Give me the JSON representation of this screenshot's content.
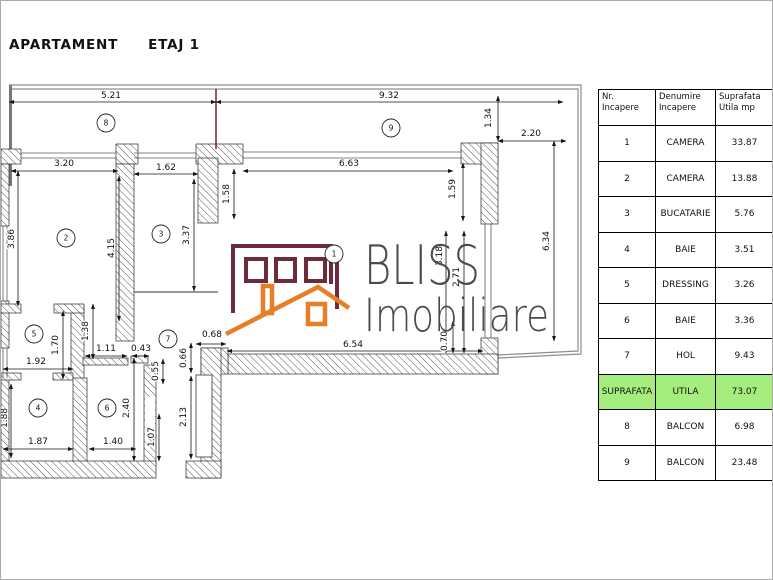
{
  "title": {
    "label": "APARTAMENT",
    "floor_label": "ETAJ 1"
  },
  "logo": {
    "brand": "BLISS",
    "brand_sub": "Imobiliare",
    "building_color": "#6e2a3a",
    "roof_color": "#e67f28",
    "text_color": "#4a4a4a"
  },
  "floor_plan": {
    "room_markers": [
      {
        "number": "8",
        "x": 105,
        "y": 122
      },
      {
        "number": "9",
        "x": 390,
        "y": 127
      },
      {
        "number": "2",
        "x": 65,
        "y": 237
      },
      {
        "number": "3",
        "x": 160,
        "y": 233
      },
      {
        "number": "1",
        "x": 333,
        "y": 253
      },
      {
        "number": "5",
        "x": 33,
        "y": 333
      },
      {
        "number": "7",
        "x": 167,
        "y": 338
      },
      {
        "number": "4",
        "x": 37,
        "y": 407
      },
      {
        "number": "6",
        "x": 106,
        "y": 407
      }
    ],
    "dimensions": [
      {
        "label": "5.21",
        "x": 110,
        "y": 97
      },
      {
        "label": "9.32",
        "x": 388,
        "y": 97
      },
      {
        "label": "1.34",
        "x": 490,
        "y": 117,
        "rot": true
      },
      {
        "label": "2.20",
        "x": 530,
        "y": 135
      },
      {
        "label": "3.20",
        "x": 63,
        "y": 165
      },
      {
        "label": "1.62",
        "x": 165,
        "y": 169
      },
      {
        "label": "6.63",
        "x": 348,
        "y": 165
      },
      {
        "label": "1.58",
        "x": 228,
        "y": 193,
        "rot": true
      },
      {
        "label": "1.59",
        "x": 454,
        "y": 188,
        "rot": true
      },
      {
        "label": "6.34",
        "x": 548,
        "y": 240,
        "rot": true
      },
      {
        "label": "3.86",
        "x": 13,
        "y": 238,
        "rot": true
      },
      {
        "label": "4.15",
        "x": 113,
        "y": 247,
        "rot": true
      },
      {
        "label": "3.37",
        "x": 188,
        "y": 234,
        "rot": true
      },
      {
        "label": "3.18",
        "x": 441,
        "y": 255,
        "rot": true
      },
      {
        "label": "2.71",
        "x": 458,
        "y": 276,
        "rot": true
      },
      {
        "label": "0.70",
        "x": 446,
        "y": 340,
        "rot": true
      },
      {
        "label": "0.68",
        "x": 211,
        "y": 336
      },
      {
        "label": "6.54",
        "x": 352,
        "y": 346
      },
      {
        "label": "1.70",
        "x": 57,
        "y": 344,
        "rot": true
      },
      {
        "label": "1.38",
        "x": 87,
        "y": 330,
        "rot": true
      },
      {
        "label": "1.11",
        "x": 105,
        "y": 350
      },
      {
        "label": "0.43",
        "x": 140,
        "y": 350
      },
      {
        "label": "1.92",
        "x": 35,
        "y": 363
      },
      {
        "label": "0.55",
        "x": 157,
        "y": 370,
        "rot": true
      },
      {
        "label": "0.66",
        "x": 185,
        "y": 357,
        "rot": true
      },
      {
        "label": "1.88",
        "x": 6,
        "y": 417,
        "rot": true
      },
      {
        "label": "1.87",
        "x": 37,
        "y": 443
      },
      {
        "label": "2.40",
        "x": 128,
        "y": 407,
        "rot": true
      },
      {
        "label": "1.40",
        "x": 112,
        "y": 443
      },
      {
        "label": "1.07",
        "x": 153,
        "y": 436,
        "rot": true
      },
      {
        "label": "2.13",
        "x": 185,
        "y": 416,
        "rot": true
      }
    ]
  },
  "table": {
    "headers": [
      "Nr. Incapere",
      "Denumire Incapere",
      "Suprafata Utila mp"
    ],
    "rows": [
      {
        "nr": "1",
        "name": "CAMERA",
        "area": "33.87",
        "highlight": false
      },
      {
        "nr": "2",
        "name": "CAMERA",
        "area": "13.88",
        "highlight": false
      },
      {
        "nr": "3",
        "name": "BUCATARIE",
        "area": "5.76",
        "highlight": false
      },
      {
        "nr": "4",
        "name": "BAIE",
        "area": "3.51",
        "highlight": false
      },
      {
        "nr": "5",
        "name": "DRESSING",
        "area": "3.26",
        "highlight": false
      },
      {
        "nr": "6",
        "name": "BAIE",
        "area": "3.36",
        "highlight": false
      },
      {
        "nr": "7",
        "name": "HOL",
        "area": "9.43",
        "highlight": false
      },
      {
        "nr": "SUPRAFATA",
        "name": "UTILA",
        "area": "73.07",
        "highlight": true
      },
      {
        "nr": "8",
        "name": "BALCON",
        "area": "6.98",
        "highlight": false
      },
      {
        "nr": "9",
        "name": "BALCON",
        "area": "23.48",
        "highlight": false
      }
    ],
    "highlight_color": "#a5ee7d"
  }
}
